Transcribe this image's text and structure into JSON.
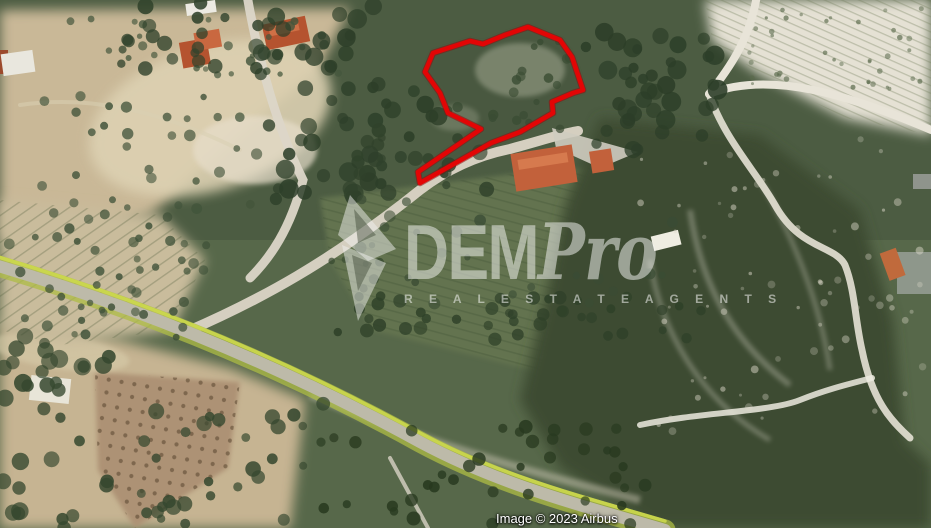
{
  "watermark": {
    "brand_bold": "DEM",
    "brand_italic": "Pro",
    "tagline": "R E A L E S T A T E A G E N T S",
    "color": "#f3f3f1",
    "opacity": 0.52
  },
  "attribution": {
    "text": "Image © 2023 Airbus",
    "color": "#ffffff"
  },
  "plot_outline": {
    "color": "#e30505",
    "shadow_color": "#8f0e0e",
    "stroke_width": 4.5,
    "points": "433,53 470,41 483,44 505,35 528,27 560,40 572,57 583,90 573,93 552,102 553,113 520,132 491,143 420,183 418,172 481,129 448,113 440,93 425,72"
  },
  "palette": {
    "terrain_green": "#57684a",
    "forest_green": "#2d3f29",
    "bare_soil_tan": "#c9b897",
    "terrace_white": "#e5e1d4",
    "road_gray": "#bdbaa9",
    "road_verge_yellow_green": "#b8c84a",
    "roof_terracotta": "#b5532f"
  }
}
